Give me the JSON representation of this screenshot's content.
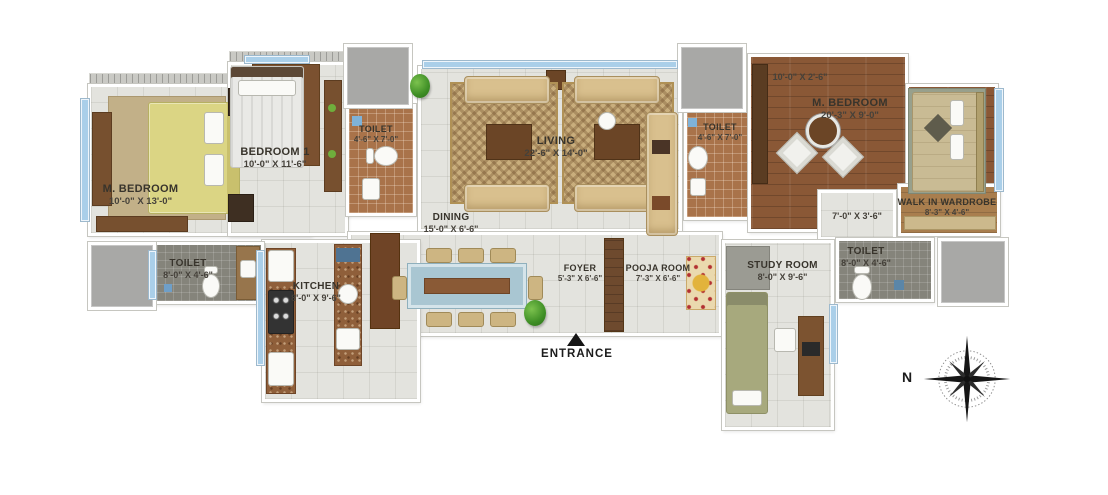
{
  "plan_title": "apartment-floor-plan",
  "labels": {
    "entrance": "ENTRANCE",
    "north": "N"
  },
  "rooms": {
    "m_bedroom_left": {
      "name": "M. BEDROOM",
      "dim": "10'-0\" X 13'-0\""
    },
    "bedroom_1": {
      "name": "BEDROOM 1",
      "dim": "10'-0\" X 11'-6\""
    },
    "toilet_1": {
      "name": "TOILET",
      "dim": "4'-6\" X 7'-0\""
    },
    "living": {
      "name": "LIVING",
      "dim": "22'-6\" X 14'-0\""
    },
    "toilet_2": {
      "name": "TOILET",
      "dim": "4'-6\" X 7'-0\""
    },
    "m_bedroom_right": {
      "name": "M. BEDROOM",
      "dim": "20'-3\" X 9'-0\"",
      "deck_dim": "10'-0\" X 2'-6\""
    },
    "walk_in_wardrobe": {
      "name": "WALK IN WARDROBE",
      "dim": "8'-3\" X 4'-6\""
    },
    "passage": {
      "dim": "7'-0\" X 3'-6\""
    },
    "toilet_3": {
      "name": "TOILET",
      "dim": "8'-0\" X 4'-6\""
    },
    "kitchen": {
      "name": "KITCHEN",
      "dim": "8'-0\" X 9'-6\""
    },
    "dining": {
      "name": "DINING",
      "dim": "15'-0\" X 6'-6\""
    },
    "foyer": {
      "name": "FOYER",
      "dim": "5'-3\" X 6'-6\""
    },
    "pooja_room": {
      "name": "POOJA ROOM",
      "dim": "7'-3\" X 6'-6\""
    },
    "study_room": {
      "name": "STUDY ROOM",
      "dim": "8'-0\" X 9'-6\""
    },
    "toilet_4": {
      "name": "TOILET",
      "dim": "8'-0\" X 4'-6\""
    }
  },
  "colors": {
    "tile_floor": "#e3e3de",
    "wood_floor": "#8a5836",
    "terracotta_tile": "#a9734a",
    "dark_tile": "#85847b",
    "window_blue": "#aacfe9",
    "duct_gray": "#a8a8a6",
    "sofa_tan": "#d9c08e",
    "label_text": "#38342c",
    "compass_black": "#1c1c1c"
  }
}
